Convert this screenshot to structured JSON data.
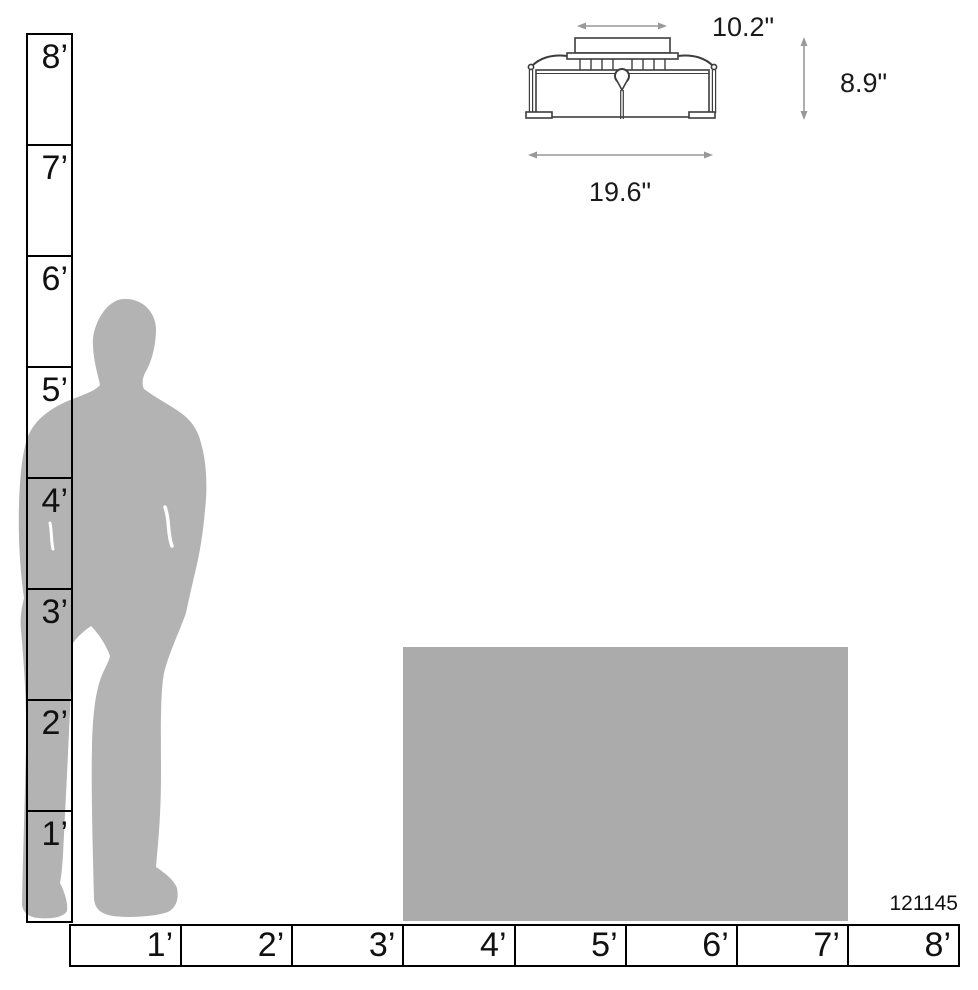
{
  "diagram": {
    "item_number": "121145",
    "fixture": {
      "canopy_width_label": "10.2\"",
      "height_label": "8.9\"",
      "width_label": "19.6\""
    },
    "vertical_ruler": {
      "unit": "feet",
      "labels": [
        "8’",
        "7’",
        "6’",
        "5’",
        "4’",
        "3’",
        "2’",
        "1’"
      ]
    },
    "horizontal_ruler": {
      "unit": "feet",
      "labels": [
        "1’",
        "2’",
        "3’",
        "4’",
        "5’",
        "6’",
        "7’",
        "8’"
      ]
    },
    "colors": {
      "silhouette": "#b3b3b3",
      "table": "#ababab",
      "ruler_line": "#000000",
      "fixture_line": "#3d3d3d",
      "dimension_arrow": "#999999",
      "text": "#1a1a1a"
    }
  }
}
